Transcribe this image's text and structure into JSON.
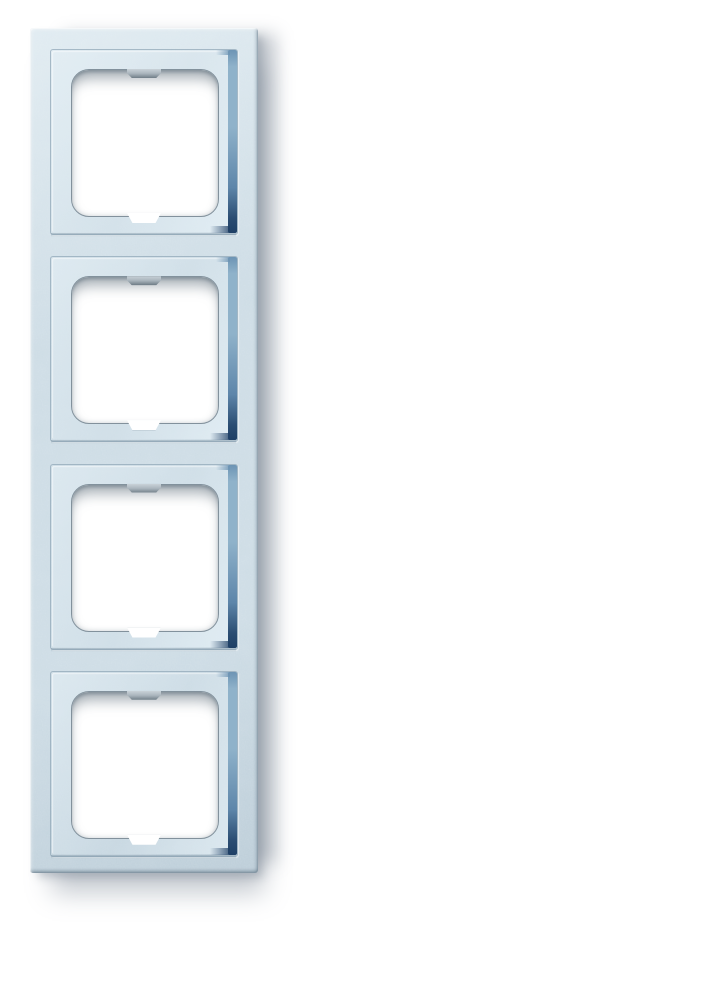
{
  "photo": {
    "subject": "four-gang vertical switch cover frame",
    "finish": "speckled alu-silver light blue",
    "background": "white",
    "gang_count": 4
  },
  "frame": {
    "openings": [
      {
        "name": "module-opening-1"
      },
      {
        "name": "module-opening-2"
      },
      {
        "name": "module-opening-3"
      },
      {
        "name": "module-opening-4"
      }
    ],
    "layout": {
      "unit_stride_px": 207.25,
      "first_unit_top_px": 21
    },
    "colors": {
      "base": "#cddce5",
      "base_light": "#e0ebf1",
      "base_deep": "#bccdd8",
      "groove_blue_light": "#8fb2ca",
      "groove_blue_dark": "#1f4066",
      "opening_fill": "#ffffff",
      "opening_rim": "#82919c",
      "tab_gray": "#aab5bd",
      "shadow": "rgba(128,140,152,0.45)"
    }
  }
}
